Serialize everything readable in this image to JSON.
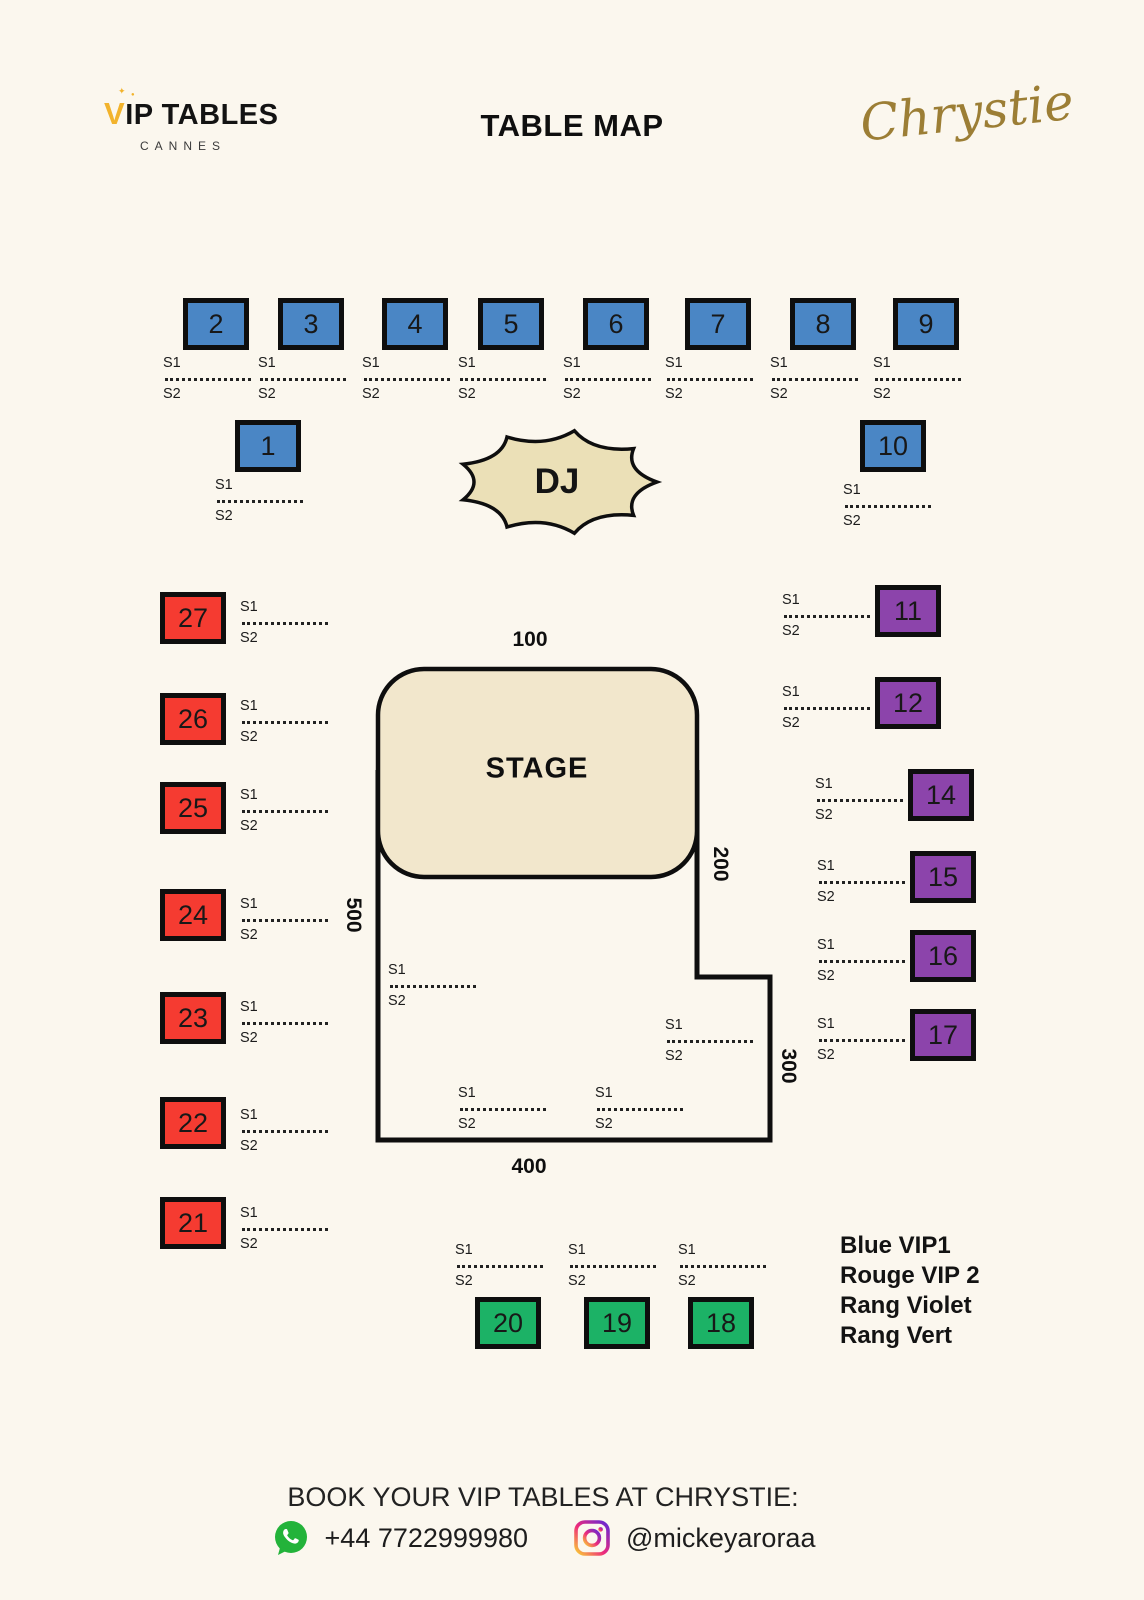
{
  "header": {
    "logo_accent": "V",
    "logo_text": "IP TABLES",
    "logo_subtitle": "CANNES",
    "title": "TABLE MAP",
    "brand": "Chrystie"
  },
  "map": {
    "stage_label": "STAGE",
    "dj_label": "DJ",
    "zones": {
      "top": "100",
      "right": "200",
      "lower_right": "300",
      "bottom": "400",
      "left": "500"
    },
    "seat_labels": {
      "s1": "S1",
      "s2": "S2"
    },
    "tables": [
      {
        "n": "2",
        "cat": "blue",
        "x": 183,
        "y": 298
      },
      {
        "n": "3",
        "cat": "blue",
        "x": 278,
        "y": 298
      },
      {
        "n": "4",
        "cat": "blue",
        "x": 382,
        "y": 298
      },
      {
        "n": "5",
        "cat": "blue",
        "x": 478,
        "y": 298
      },
      {
        "n": "6",
        "cat": "blue",
        "x": 583,
        "y": 298
      },
      {
        "n": "7",
        "cat": "blue",
        "x": 685,
        "y": 298
      },
      {
        "n": "8",
        "cat": "blue",
        "x": 790,
        "y": 298
      },
      {
        "n": "9",
        "cat": "blue",
        "x": 893,
        "y": 298
      },
      {
        "n": "1",
        "cat": "blue",
        "x": 235,
        "y": 420
      },
      {
        "n": "10",
        "cat": "blue",
        "x": 860,
        "y": 420
      },
      {
        "n": "27",
        "cat": "red",
        "x": 160,
        "y": 592
      },
      {
        "n": "26",
        "cat": "red",
        "x": 160,
        "y": 693
      },
      {
        "n": "25",
        "cat": "red",
        "x": 160,
        "y": 782
      },
      {
        "n": "24",
        "cat": "red",
        "x": 160,
        "y": 889
      },
      {
        "n": "23",
        "cat": "red",
        "x": 160,
        "y": 992
      },
      {
        "n": "22",
        "cat": "red",
        "x": 160,
        "y": 1097
      },
      {
        "n": "21",
        "cat": "red",
        "x": 160,
        "y": 1197
      },
      {
        "n": "11",
        "cat": "purple",
        "x": 875,
        "y": 585
      },
      {
        "n": "12",
        "cat": "purple",
        "x": 875,
        "y": 677
      },
      {
        "n": "14",
        "cat": "purple",
        "x": 908,
        "y": 769
      },
      {
        "n": "15",
        "cat": "purple",
        "x": 910,
        "y": 851
      },
      {
        "n": "16",
        "cat": "purple",
        "x": 910,
        "y": 930
      },
      {
        "n": "17",
        "cat": "purple",
        "x": 910,
        "y": 1009
      },
      {
        "n": "20",
        "cat": "green",
        "x": 475,
        "y": 1297
      },
      {
        "n": "19",
        "cat": "green",
        "x": 584,
        "y": 1297
      },
      {
        "n": "18",
        "cat": "green",
        "x": 688,
        "y": 1297
      }
    ],
    "seat_blocks": [
      {
        "x": 163,
        "y": 356
      },
      {
        "x": 258,
        "y": 356
      },
      {
        "x": 362,
        "y": 356
      },
      {
        "x": 458,
        "y": 356
      },
      {
        "x": 563,
        "y": 356
      },
      {
        "x": 665,
        "y": 356
      },
      {
        "x": 770,
        "y": 356
      },
      {
        "x": 873,
        "y": 356
      },
      {
        "x": 215,
        "y": 478
      },
      {
        "x": 843,
        "y": 483
      },
      {
        "x": 240,
        "y": 600
      },
      {
        "x": 240,
        "y": 699
      },
      {
        "x": 240,
        "y": 788
      },
      {
        "x": 240,
        "y": 897
      },
      {
        "x": 240,
        "y": 1000
      },
      {
        "x": 240,
        "y": 1108
      },
      {
        "x": 240,
        "y": 1206
      },
      {
        "x": 782,
        "y": 593
      },
      {
        "x": 782,
        "y": 685
      },
      {
        "x": 815,
        "y": 777
      },
      {
        "x": 817,
        "y": 859
      },
      {
        "x": 817,
        "y": 938
      },
      {
        "x": 817,
        "y": 1017
      },
      {
        "x": 455,
        "y": 1243
      },
      {
        "x": 568,
        "y": 1243
      },
      {
        "x": 678,
        "y": 1243
      },
      {
        "x": 388,
        "y": 963
      },
      {
        "x": 665,
        "y": 1018
      },
      {
        "x": 458,
        "y": 1086
      },
      {
        "x": 595,
        "y": 1086
      }
    ]
  },
  "legend": {
    "items": [
      "Blue VIP1",
      "Rouge VIP 2",
      "Rang Violet",
      "Rang Vert"
    ]
  },
  "footer": {
    "book_text": "BOOK  YOUR VIP TABLES AT CHRYSTIE:",
    "phone": "+44 7722999980",
    "instagram_handle": "@mickeyaroraa"
  },
  "colors": {
    "background": "#FBF7EE",
    "blue": "#4A86C5",
    "red": "#F53B31",
    "purple": "#8C44AB",
    "green": "#1CB266",
    "stage_fill": "#F2E7CC",
    "dj_fill": "#EBE0B7",
    "outline": "#0E0E0E",
    "logo_gold": "#F2B32C",
    "brand_gold": "#9C7E35",
    "whatsapp_green": "#23B33A"
  }
}
